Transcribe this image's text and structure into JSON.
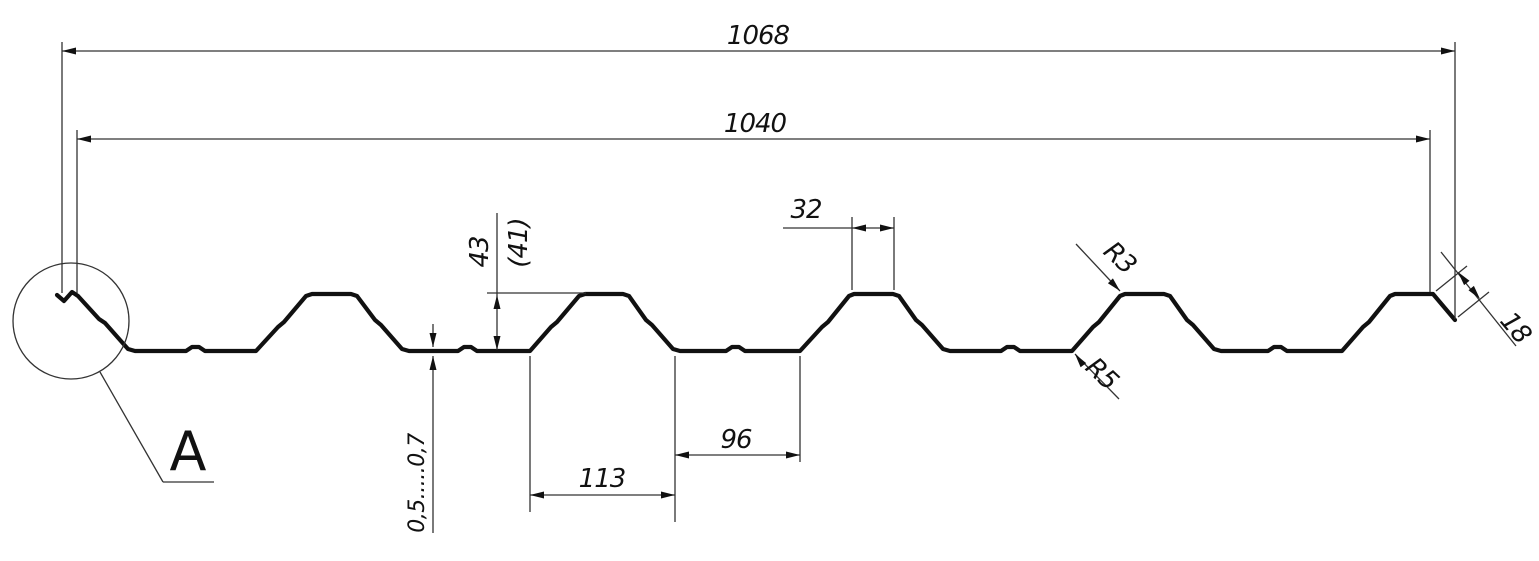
{
  "labels": {
    "overall_width": "1068",
    "cover_width": "1040",
    "rib_top_width": "32",
    "profile_height": "43",
    "profile_height_alt": "(41)",
    "rib_base_width": "113",
    "valley_width": "96",
    "top_radius": "R3",
    "bottom_radius": "R5",
    "edge_lip_length": "18",
    "sheet_thickness": "0,5.....0,7",
    "detail_label": "A"
  },
  "colors": {
    "line": "#111111",
    "background": "#ffffff"
  }
}
